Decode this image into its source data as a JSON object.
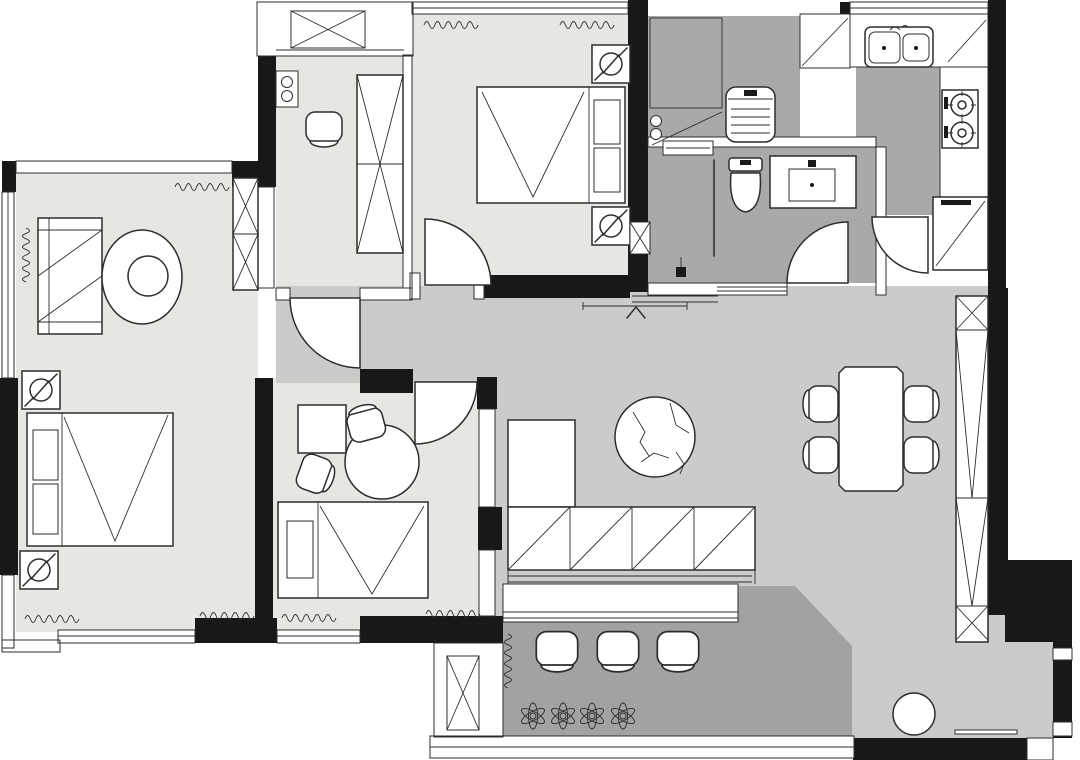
{
  "meta": {
    "type": "architectural-floor-plan",
    "style": "black-and-white plan, thick black walls, gray floor fills, no text labels",
    "labels_visible": false
  },
  "colors": {
    "background": "#ffffff",
    "wall": "#181818",
    "line": "#2d2d2d",
    "floor_bedroom": "#e6e6e3",
    "floor_living": "#cbccca",
    "floor_wet": "#a9a9a9",
    "floor_balcony": "#a2a2a2",
    "counter_dark": "#8d8d8d",
    "fixture_white": "#ffffff"
  },
  "rooms": [
    {
      "id": "master-bedroom",
      "position": "left",
      "floor": "floor_bedroom",
      "furniture": [
        "double-bed",
        "pillow",
        "pillow",
        "nightstand-with-lamp",
        "nightstand-with-lamp",
        "dresser",
        "round-lounge-chair",
        "wardrobe-x",
        "curtains",
        "windows"
      ]
    },
    {
      "id": "multipurpose-room",
      "position": "top-center-left",
      "floor": "floor_bedroom",
      "furniture": [
        "desk-chair",
        "shelf-with-meters",
        "tall-cabinet-x",
        "service-balcony",
        "washing-machine-box"
      ]
    },
    {
      "id": "bedroom-2",
      "position": "top-center",
      "floor": "floor_bedroom",
      "furniture": [
        "double-bed",
        "pillow",
        "pillow",
        "nightstand-with-lamp",
        "nightstand-with-lamp",
        "door-arc",
        "curtains",
        "window"
      ]
    },
    {
      "id": "study-bedroom",
      "position": "bottom-center-left",
      "floor": "floor_bedroom",
      "furniture": [
        "single-bed",
        "pillow",
        "round-table",
        "chair",
        "chair",
        "square-rug",
        "door-arc",
        "curtains",
        "window"
      ]
    },
    {
      "id": "kitchen",
      "position": "top-right",
      "floor": "floor_wet",
      "furniture": [
        "double-sink",
        "gas-stove-2-burner",
        "counter",
        "corner-cabinet",
        "fridge-cabinet",
        "door-arc",
        "window"
      ]
    },
    {
      "id": "bathroom",
      "position": "center-right",
      "floor": "floor_wet",
      "furniture": [
        "toilet",
        "vanity-sink",
        "shower-screen",
        "floor-drain",
        "pipe-shaft",
        "door-arc"
      ]
    },
    {
      "id": "laundry-niche",
      "position": "top-center-right",
      "floor": "floor_wet",
      "furniture": [
        "washing-machine",
        "dark-counter",
        "meter-circles"
      ]
    },
    {
      "id": "living-dining-room",
      "position": "center-right",
      "floor": "floor_living",
      "furniture": [
        "marble-coffee-table",
        "tv-cabinet-hatched",
        "dining-table",
        "dining-chair",
        "dining-chair",
        "dining-chair",
        "dining-chair",
        "storage-column-x",
        "round-stool",
        "floor-mat-line"
      ]
    },
    {
      "id": "balcony",
      "position": "bottom",
      "floor": "floor_balcony",
      "furniture": [
        "balcony-chair",
        "balcony-chair",
        "balcony-chair",
        "plant",
        "plant",
        "plant",
        "plant",
        "sliding-door-sill",
        "shaft-x-box",
        "curtain"
      ]
    },
    {
      "id": "entry",
      "position": "top-of-living-room",
      "furniture": [
        "entry-direction-arrow",
        "dimension-line",
        "threshold"
      ]
    }
  ],
  "counts": {
    "bedrooms": 3,
    "balcony_chairs": 3,
    "plants": 4,
    "dining_chairs": 4,
    "door_arcs": 5,
    "stove_burners": 2,
    "sink_basins": 2
  }
}
